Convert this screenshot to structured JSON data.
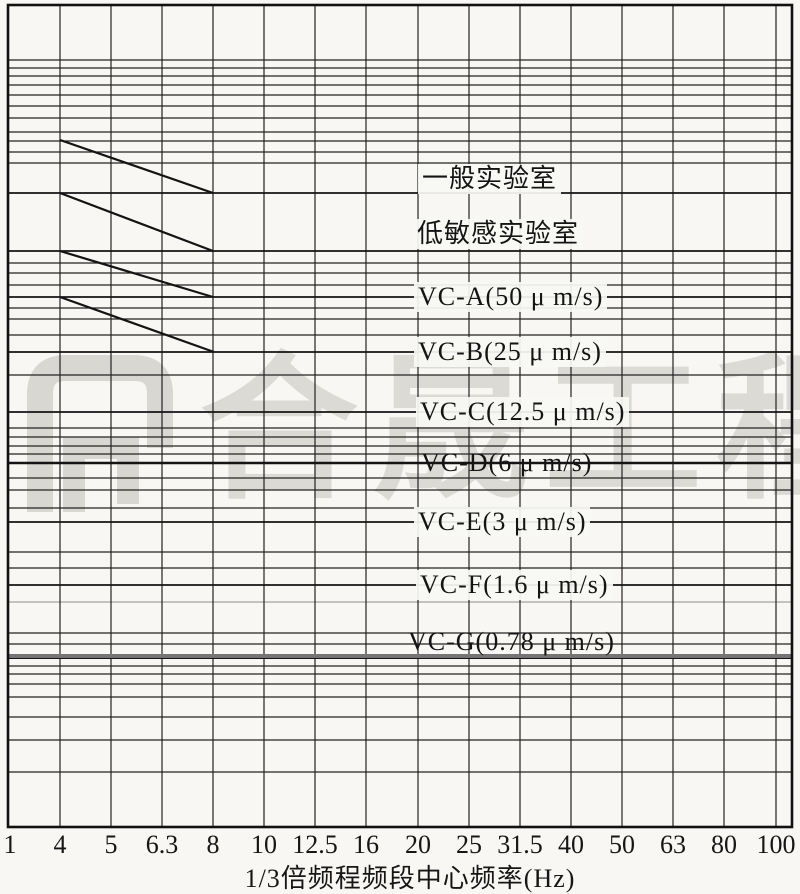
{
  "watermark": {
    "text": "合晟工程",
    "color": "#dcdad5",
    "logo": "door-bracket-logo"
  },
  "axis": {
    "title": "1/3倍频程频段中心频率(Hz)",
    "ticks": [
      "1",
      "4",
      "5",
      "6.3",
      "8",
      "10",
      "12.5",
      "16",
      "20",
      "25",
      "31.5",
      "40",
      "50",
      "63",
      "80",
      "100"
    ]
  },
  "curves": [
    {
      "id": "general-lab",
      "label": "一般实验室",
      "line_y": 193,
      "label_x": 418,
      "label_center_y": 179,
      "opaque_bg": true,
      "line_style": "normal",
      "slope": [
        60,
        140,
        213,
        193
      ]
    },
    {
      "id": "low-sensitivity-lab",
      "label": "低敏感实验室",
      "line_y": 251,
      "label_x": 413,
      "label_center_y": 234,
      "opaque_bg": true,
      "line_style": "normal",
      "slope": [
        60,
        193,
        213,
        251
      ]
    },
    {
      "id": "vc-a",
      "label": "VC-A(50 μ m/s)",
      "line_y": 297,
      "label_x": 414,
      "label_center_y": 297,
      "opaque_bg": true,
      "line_style": "normal",
      "slope": [
        60,
        251,
        213,
        297
      ]
    },
    {
      "id": "vc-b",
      "label": "VC-B(25 μ m/s)",
      "line_y": 352,
      "label_x": 414,
      "label_center_y": 352,
      "opaque_bg": true,
      "line_style": "normal",
      "slope": [
        60,
        297,
        214,
        352
      ]
    },
    {
      "id": "vc-c",
      "label": "VC-C(12.5 μ m/s)",
      "line_y": 412,
      "label_x": 416,
      "label_center_y": 412,
      "opaque_bg": true,
      "line_style": "normal",
      "slope": null
    },
    {
      "id": "vc-d",
      "label": "VC-D(6 μ m/s)",
      "line_y": 463,
      "label_x": 417,
      "label_center_y": 463,
      "opaque_bg": false,
      "line_style": "thick",
      "slope": null
    },
    {
      "id": "vc-e",
      "label": "VC-E(3 μ m/s)",
      "line_y": 522,
      "label_x": 414,
      "label_center_y": 522,
      "opaque_bg": true,
      "line_style": "normal",
      "slope": null
    },
    {
      "id": "vc-f",
      "label": "VC-F(1.6 μ m/s)",
      "line_y": 585,
      "label_x": 416,
      "label_center_y": 585,
      "opaque_bg": true,
      "line_style": "normal",
      "slope": null
    },
    {
      "id": "vc-g",
      "label": "VC-G(0.78 μ m/s)",
      "line_y": 656,
      "label_x": 404,
      "label_center_y": 642,
      "opaque_bg": false,
      "line_style": "gray-thick",
      "slope": null
    }
  ],
  "chart_data": {
    "type": "line",
    "title": "",
    "xlabel": "1/3倍频程频段中心频率(Hz)",
    "ylabel": "",
    "x_scale": "log (1/3 octave band centers)",
    "y_scale": "log velocity, axis unlabeled (μm/s)",
    "x_ticks": [
      1,
      4,
      5,
      6.3,
      8,
      10,
      12.5,
      16,
      20,
      25,
      31.5,
      40,
      50,
      63,
      80,
      100
    ],
    "grid": "dense log grid, both axes",
    "legend_position": "labels on lines inside plot",
    "series": [
      {
        "name": "一般实验室",
        "plateau_um_s": 200,
        "plateau_estimated": true,
        "points_hz_um_s": [
          [
            4,
            400
          ],
          [
            8,
            200
          ],
          [
            100,
            200
          ]
        ]
      },
      {
        "name": "低敏感实验室",
        "plateau_um_s": 100,
        "plateau_estimated": true,
        "points_hz_um_s": [
          [
            4,
            200
          ],
          [
            8,
            100
          ],
          [
            100,
            100
          ]
        ]
      },
      {
        "name": "VC-A",
        "plateau_um_s": 50,
        "plateau_estimated": false,
        "points_hz_um_s": [
          [
            4,
            100
          ],
          [
            8,
            50
          ],
          [
            100,
            50
          ]
        ]
      },
      {
        "name": "VC-B",
        "plateau_um_s": 25,
        "plateau_estimated": false,
        "points_hz_um_s": [
          [
            4,
            50
          ],
          [
            8,
            25
          ],
          [
            100,
            25
          ]
        ]
      },
      {
        "name": "VC-C",
        "plateau_um_s": 12.5,
        "plateau_estimated": false,
        "points_hz_um_s": [
          [
            1,
            12.5
          ],
          [
            100,
            12.5
          ]
        ]
      },
      {
        "name": "VC-D",
        "plateau_um_s": 6,
        "plateau_estimated": false,
        "points_hz_um_s": [
          [
            1,
            6
          ],
          [
            100,
            6
          ]
        ]
      },
      {
        "name": "VC-E",
        "plateau_um_s": 3,
        "plateau_estimated": false,
        "points_hz_um_s": [
          [
            1,
            3
          ],
          [
            100,
            3
          ]
        ]
      },
      {
        "name": "VC-F",
        "plateau_um_s": 1.6,
        "plateau_estimated": false,
        "points_hz_um_s": [
          [
            1,
            1.6
          ],
          [
            100,
            1.6
          ]
        ]
      },
      {
        "name": "VC-G",
        "plateau_um_s": 0.78,
        "plateau_estimated": false,
        "points_hz_um_s": [
          [
            1,
            0.78
          ],
          [
            100,
            0.78
          ]
        ]
      }
    ]
  },
  "layout": {
    "w": 800,
    "h": 894,
    "border": {
      "l": 8,
      "r": 792,
      "t": 5,
      "b": 827
    },
    "v_lines": [
      60,
      111,
      162,
      213,
      264,
      315,
      366,
      418,
      469,
      520,
      571,
      622,
      673,
      724,
      776
    ],
    "h_lines": [
      60,
      68,
      76,
      85,
      95,
      106,
      118,
      132,
      141,
      152,
      163,
      263,
      273,
      285,
      308,
      319,
      335,
      375,
      428,
      437,
      446,
      454,
      478,
      490,
      508,
      552,
      568,
      633,
      644,
      666,
      674,
      684,
      697,
      717,
      740,
      772
    ],
    "faint_lines": [
      602
    ],
    "tick_x": [
      10,
      60,
      111,
      162,
      213,
      264,
      315,
      366,
      418,
      469,
      520,
      571,
      622,
      673,
      724,
      776
    ],
    "colors": {
      "paper": "#f8f7f4",
      "grid": "#232323",
      "curve": "#141414",
      "faint": "#8c8c8c",
      "gray_thick": "#757575",
      "border": "#111111"
    }
  }
}
